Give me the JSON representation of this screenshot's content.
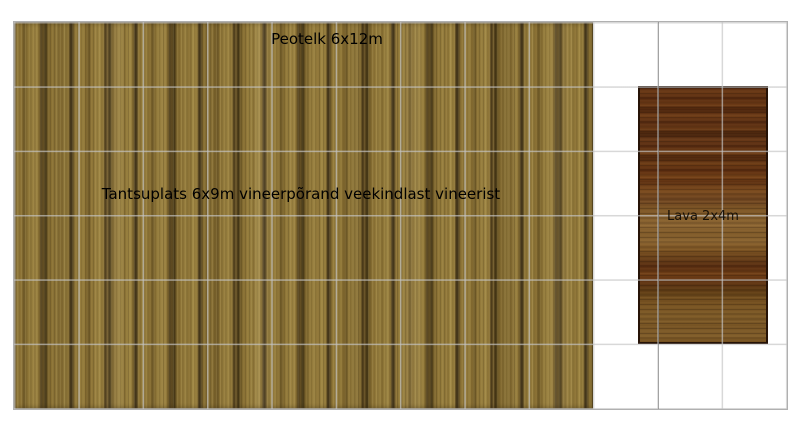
{
  "plan": {
    "background_color": "#ffffff",
    "grid": {
      "columns": 12,
      "rows": 6,
      "line_color": "#d6d6d6",
      "major_line_color": "#a8a8a8",
      "border_color": "#b0b0b0"
    },
    "tent": {
      "label": "Peotelk 6x12m"
    },
    "dance_floor": {
      "label": "Tantsuplats 6x9m vineerpõrand veekindlast vineerist",
      "wood_light": "#a08845",
      "wood_mid": "#8a7134",
      "wood_dark": "#3f3214"
    },
    "stage": {
      "label": "Lava 2x4m",
      "wood_light": "#8a6432",
      "wood_mid": "#6e3b16",
      "wood_dark": "#45220c",
      "border_color": "#261307"
    }
  }
}
